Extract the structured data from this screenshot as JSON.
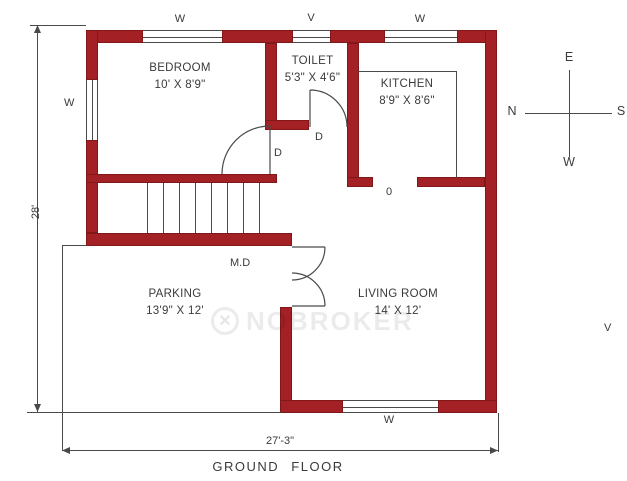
{
  "title": "GROUND FLOOR",
  "rooms": [
    {
      "name": "BEDROOM",
      "dims": "10' X 8'9\""
    },
    {
      "name": "TOILET",
      "dims": "5'3\" X 4'6\""
    },
    {
      "name": "KITCHEN",
      "dims": "8'9\" X 8'6\""
    },
    {
      "name": "PARKING",
      "dims": "13'9\" X 12'"
    },
    {
      "name": "LIVING ROOM",
      "dims": "14' X 12'"
    }
  ],
  "labels": {
    "window_top_bedroom": "W",
    "ventilator_top_toilet": "V",
    "window_top_kitchen": "W",
    "window_left_bedroom": "W",
    "window_bottom_living": "W",
    "ventilator_right": "V",
    "door_bedroom": "D",
    "door_toilet": "D",
    "main_door": "M.D",
    "kitchen_opening": "0"
  },
  "dimensions": {
    "left_total": "28'",
    "bottom_total": "27'-3\""
  },
  "compass": {
    "top": "E",
    "left": "N",
    "right": "S",
    "bottom": "W"
  },
  "watermark": {
    "text": "NOBROKER",
    "icon_glyph": "✕"
  },
  "colors": {
    "wall": "#a32125",
    "line": "#4a4a4a",
    "text": "#3a3a3a"
  }
}
